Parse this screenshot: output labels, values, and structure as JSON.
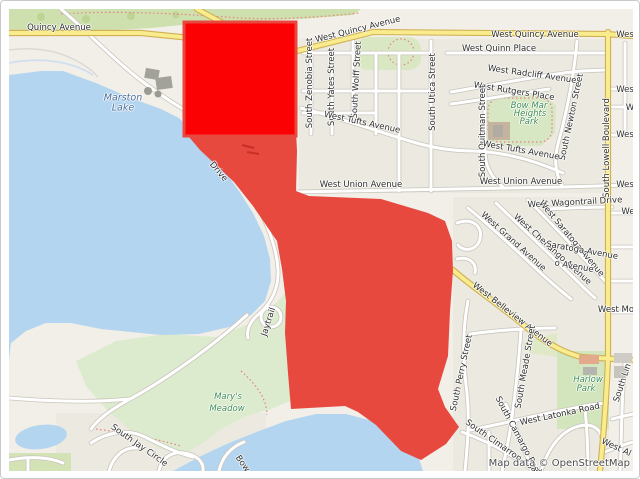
{
  "map": {
    "attribution": "Map data © OpenStreetMap",
    "colors": {
      "land": "#f2efe8",
      "residential": "#ebe9e0",
      "water": "#b4d5ef",
      "greenspace": "#d5e6c0",
      "top_greenbelt": "#cde0ad",
      "road_white": "#ffffff",
      "road_casing": "#c9c5bc",
      "road_yellow": "#f8ec8d",
      "road_yellow_casing": "#d1b055",
      "overlay_polygon_red": "#e8493f",
      "overlay_rectangle_red": "#fb0104",
      "street_label": "#2e2e2e",
      "park_label": "#3f8d55",
      "water_label": "#4c6f9c"
    },
    "overlays": {
      "rectangle": {
        "x": 183,
        "y": 21,
        "w": 112,
        "h": 114,
        "color": "#fb0104",
        "stroke": "#e8493f"
      },
      "polygon": {
        "color": "#e8493f",
        "points": [
          [
            183,
            130
          ],
          [
            295,
            130
          ],
          [
            296,
            150
          ],
          [
            295,
            190
          ],
          [
            308,
            195
          ],
          [
            380,
            198
          ],
          [
            427,
            212
          ],
          [
            444,
            220
          ],
          [
            451,
            240
          ],
          [
            452,
            270
          ],
          [
            449,
            310
          ],
          [
            447,
            355
          ],
          [
            437,
            388
          ],
          [
            444,
            406
          ],
          [
            458,
            426
          ],
          [
            445,
            443
          ],
          [
            420,
            459
          ],
          [
            400,
            450
          ],
          [
            375,
            424
          ],
          [
            357,
            411
          ],
          [
            344,
            405
          ],
          [
            290,
            408
          ],
          [
            287,
            372
          ],
          [
            284,
            332
          ],
          [
            285,
            300
          ],
          [
            281,
            268
          ],
          [
            276,
            240
          ],
          [
            267,
            227
          ],
          [
            252,
            205
          ],
          [
            233,
            181
          ],
          [
            215,
            164
          ],
          [
            199,
            149
          ]
        ]
      }
    },
    "labels": [
      {
        "t": "Quincy Avenue",
        "x": 58,
        "y": 27,
        "r": 0
      },
      {
        "t": "West Quincy Avenue",
        "x": 357,
        "y": 29,
        "r": -14
      },
      {
        "t": "West Quincy Avenue",
        "x": 534,
        "y": 34,
        "r": 0
      },
      {
        "t": "Wes",
        "x": 624,
        "y": 34,
        "r": 0
      },
      {
        "t": "West Quinn Place",
        "x": 498,
        "y": 48,
        "r": 0
      },
      {
        "t": "West Radcliff Avenue",
        "x": 531,
        "y": 74,
        "r": 8
      },
      {
        "t": "West Rutgers Place",
        "x": 513,
        "y": 91,
        "r": 9
      },
      {
        "t": "Bow Mar",
        "x": 528,
        "y": 105,
        "r": 0,
        "c": "park"
      },
      {
        "t": "Heights",
        "x": 529,
        "y": 113,
        "r": 0,
        "c": "park"
      },
      {
        "t": "Park",
        "x": 528,
        "y": 121,
        "r": 0,
        "c": "park"
      },
      {
        "t": "South Zenobia Street",
        "x": 309,
        "y": 82,
        "r": -90
      },
      {
        "t": "South Yates Street",
        "x": 331,
        "y": 86,
        "r": -90
      },
      {
        "t": "South Wolff Street",
        "x": 356,
        "y": 79,
        "r": -87
      },
      {
        "t": "South Utica Street",
        "x": 432,
        "y": 91,
        "r": -90
      },
      {
        "t": "South Quitman Street",
        "x": 482,
        "y": 130,
        "r": -90
      },
      {
        "t": "South Newton Street",
        "x": 571,
        "y": 116,
        "r": -78
      },
      {
        "t": "South Lowell Boulevard",
        "x": 606,
        "y": 147,
        "r": -90
      },
      {
        "t": "West Tufts Avenue",
        "x": 361,
        "y": 122,
        "r": 12
      },
      {
        "t": "West Tufts Avenue",
        "x": 520,
        "y": 150,
        "r": 10
      },
      {
        "t": "Wes",
        "x": 624,
        "y": 89,
        "r": 0
      },
      {
        "t": "W",
        "x": 629,
        "y": 107,
        "r": 0
      },
      {
        "t": "Wes",
        "x": 624,
        "y": 134,
        "r": 0
      },
      {
        "t": "West Union Avenue",
        "x": 360,
        "y": 184,
        "r": 0
      },
      {
        "t": "West Union Avenue",
        "x": 520,
        "y": 181,
        "r": 0
      },
      {
        "t": "Wes",
        "x": 624,
        "y": 184,
        "r": 0
      },
      {
        "t": "West Wagontrail Drive",
        "x": 574,
        "y": 202,
        "r": -3
      },
      {
        "t": "We",
        "x": 627,
        "y": 211,
        "r": 0
      },
      {
        "t": "West Grand Avenue",
        "x": 512,
        "y": 241,
        "r": 42
      },
      {
        "t": "West Chenango Avenue",
        "x": 551,
        "y": 249,
        "r": 42
      },
      {
        "t": "West Saratoga Avenue",
        "x": 570,
        "y": 238,
        "r": 50
      },
      {
        "t": "Saratoga Avenue",
        "x": 581,
        "y": 250,
        "r": 10
      },
      {
        "t": "o Avenue",
        "x": 573,
        "y": 266,
        "r": 10
      },
      {
        "t": "West Mo",
        "x": 615,
        "y": 309,
        "r": 0
      },
      {
        "t": "West Belleview Avenue",
        "x": 511,
        "y": 314,
        "r": 38
      },
      {
        "t": "South Perry Street",
        "x": 461,
        "y": 372,
        "r": -78
      },
      {
        "t": "South Meade Street",
        "x": 525,
        "y": 366,
        "r": -80
      },
      {
        "t": "Harlow",
        "x": 587,
        "y": 379,
        "r": 0,
        "c": "park"
      },
      {
        "t": "Park",
        "x": 585,
        "y": 388,
        "r": 0,
        "c": "park"
      },
      {
        "t": "West Latonka Road",
        "x": 559,
        "y": 414,
        "r": -12
      },
      {
        "t": "South Camargo Road",
        "x": 517,
        "y": 436,
        "r": 62
      },
      {
        "t": "South Cimarron Road",
        "x": 502,
        "y": 447,
        "r": 35
      },
      {
        "t": "South Lin",
        "x": 622,
        "y": 382,
        "r": -72
      },
      {
        "t": "West Al",
        "x": 615,
        "y": 447,
        "r": 25
      },
      {
        "t": "Marston",
        "x": 122,
        "y": 97,
        "r": 0,
        "c": "water"
      },
      {
        "t": "Lake",
        "x": 122,
        "y": 107,
        "r": 0,
        "c": "water"
      },
      {
        "t": "Drive",
        "x": 217,
        "y": 171,
        "r": 50
      },
      {
        "t": "Jaytrail",
        "x": 268,
        "y": 321,
        "r": -72
      },
      {
        "t": "Mary's",
        "x": 227,
        "y": 396,
        "r": 0,
        "c": "park"
      },
      {
        "t": "Meadow",
        "x": 226,
        "y": 408,
        "r": 0,
        "c": "park"
      },
      {
        "t": "South Jay Circle",
        "x": 138,
        "y": 445,
        "r": 35
      },
      {
        "t": "Bow",
        "x": 241,
        "y": 463,
        "r": 55
      }
    ]
  }
}
